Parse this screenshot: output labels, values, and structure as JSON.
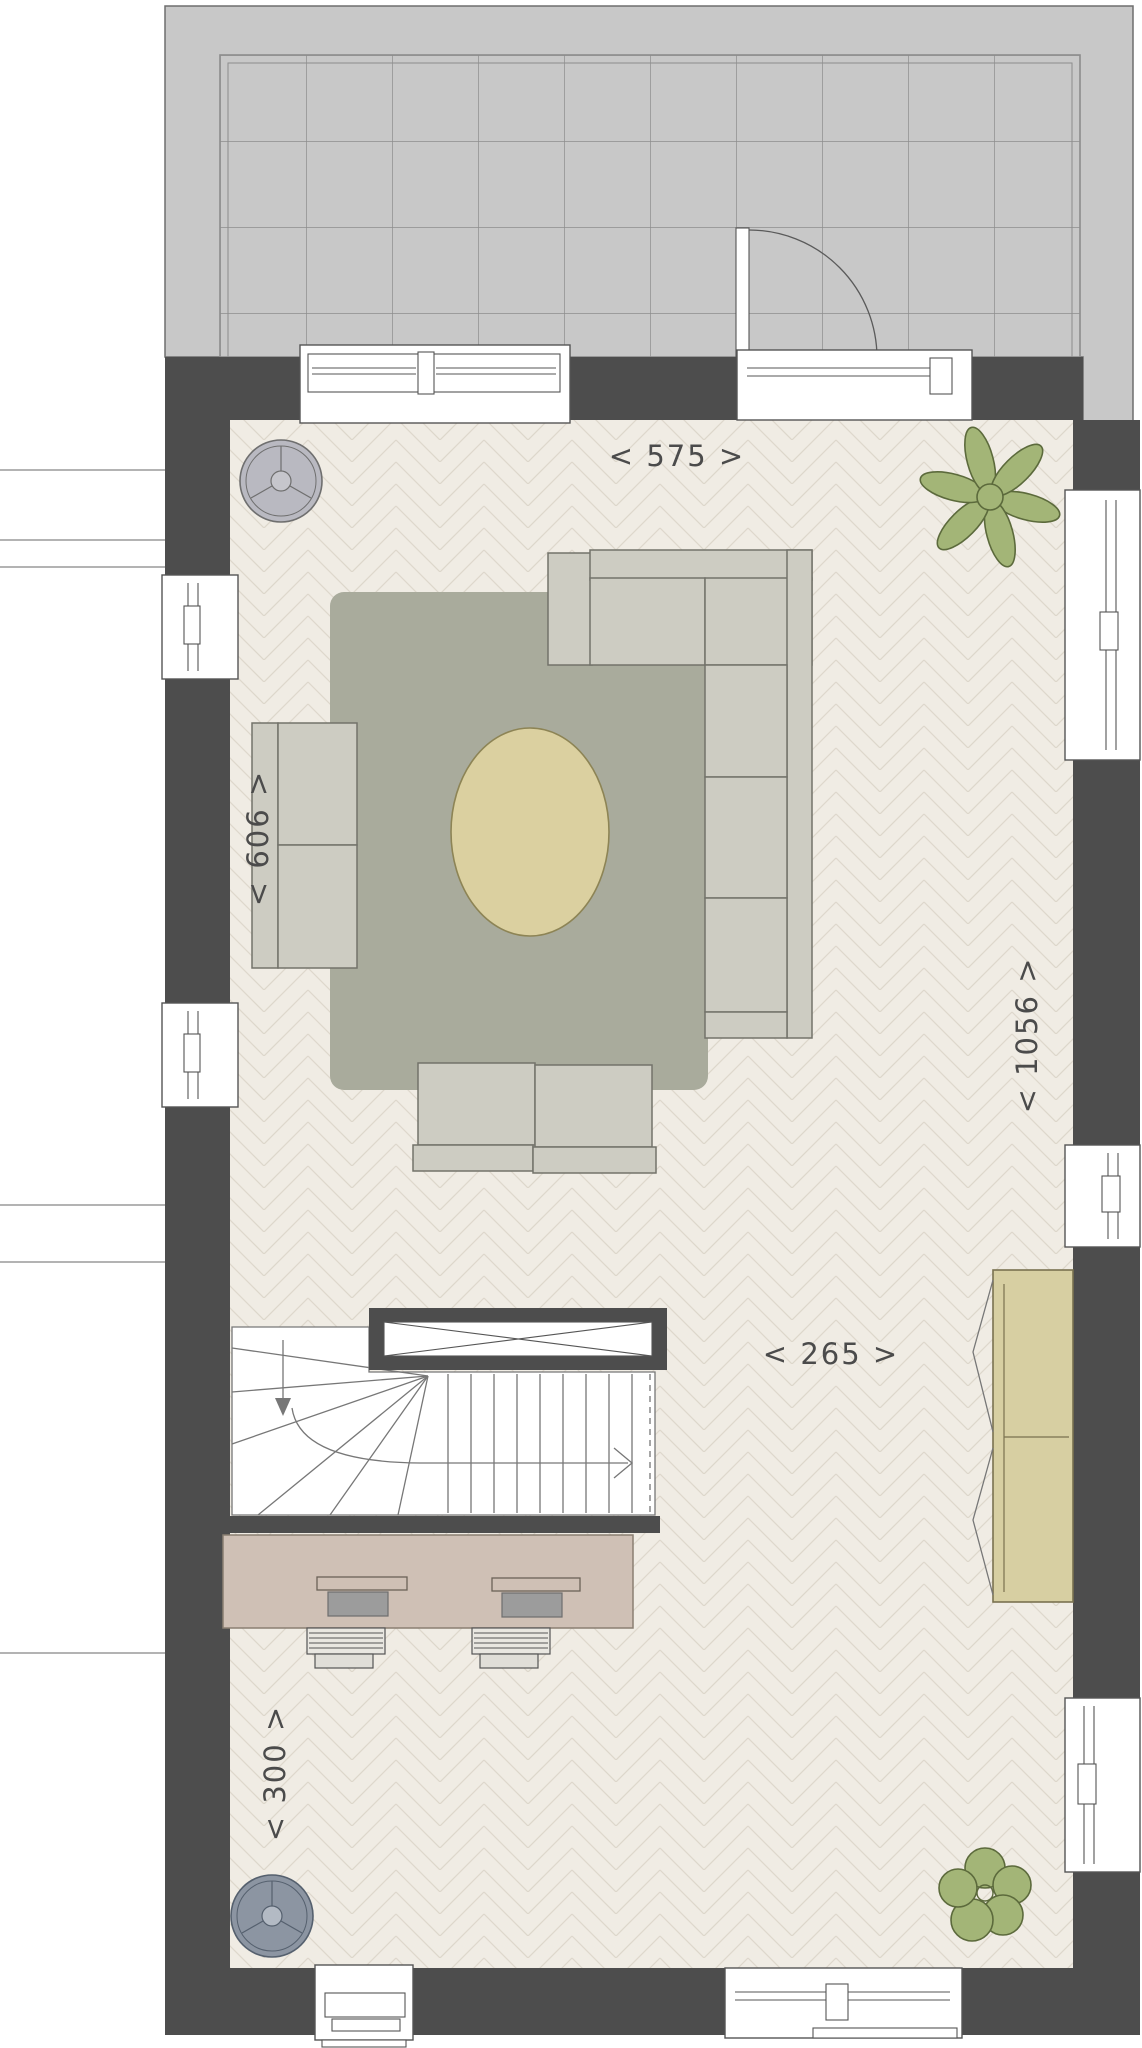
{
  "dimensions": {
    "top": "< 575 >",
    "left": "< 606 >",
    "right": "< 1056 >",
    "middle": "< 265 >",
    "bottom": "< 300 >"
  },
  "colors": {
    "wall": "#4d4d4d",
    "terrace": "#c8c8c8",
    "terrace-line": "#8d8d8d",
    "floor": "#f0ece4",
    "floor-line": "#ddd7cb",
    "rug": "#a9ab9c",
    "table": "#dbd0a0",
    "table-line": "#8d8455",
    "sofa": "#cdccc2",
    "sofa-line": "#73736a",
    "desk": "#cfc0b5",
    "desk-line": "#8a7f72",
    "cabinet": "#d7cfa2",
    "cabinet-line": "#7a7250",
    "plant": "#a3b577",
    "plant-line": "#5c6a3c",
    "fixture-top": "#b9b9c1",
    "fixture-bottom": "#8c95a2",
    "monitor": "#9c9c9c",
    "chair": "#e9e7e1",
    "label": "#4b4b4b",
    "line": "#777777",
    "frame": "#555555"
  }
}
